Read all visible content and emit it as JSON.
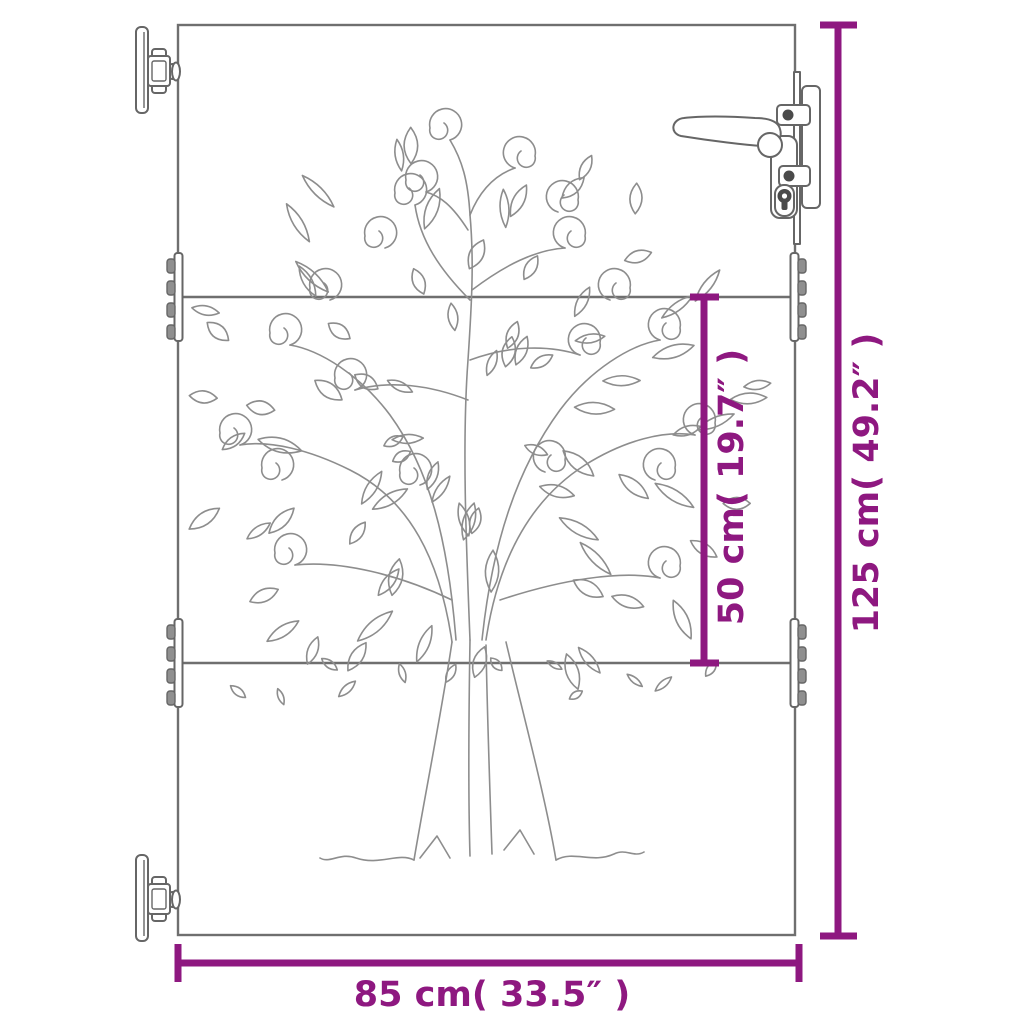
{
  "diagram": {
    "kind": "product-dimension-diagram",
    "subject": "garden gate with tree-of-life cutout design",
    "dimensions": {
      "overall_height_label": "125 cm( 49.2″ )",
      "section_height_label": "50 cm( 19.7″ )",
      "overall_width_label": "85 cm( 33.5″ )"
    },
    "parts": {
      "gate_panel": "gate-panel",
      "cutout_design": "tree-of-life-cutout",
      "hinges": "wall-mount-hinge",
      "handle": "lever-handle-with-lock-cylinder",
      "mid_brackets": "panel-joint-bracket"
    },
    "colors": {
      "dimension_accent": "#8E1880",
      "outline_gray": "#6f6f6f",
      "artwork_gray": "#8d8d8d",
      "background": "#ffffff"
    }
  }
}
